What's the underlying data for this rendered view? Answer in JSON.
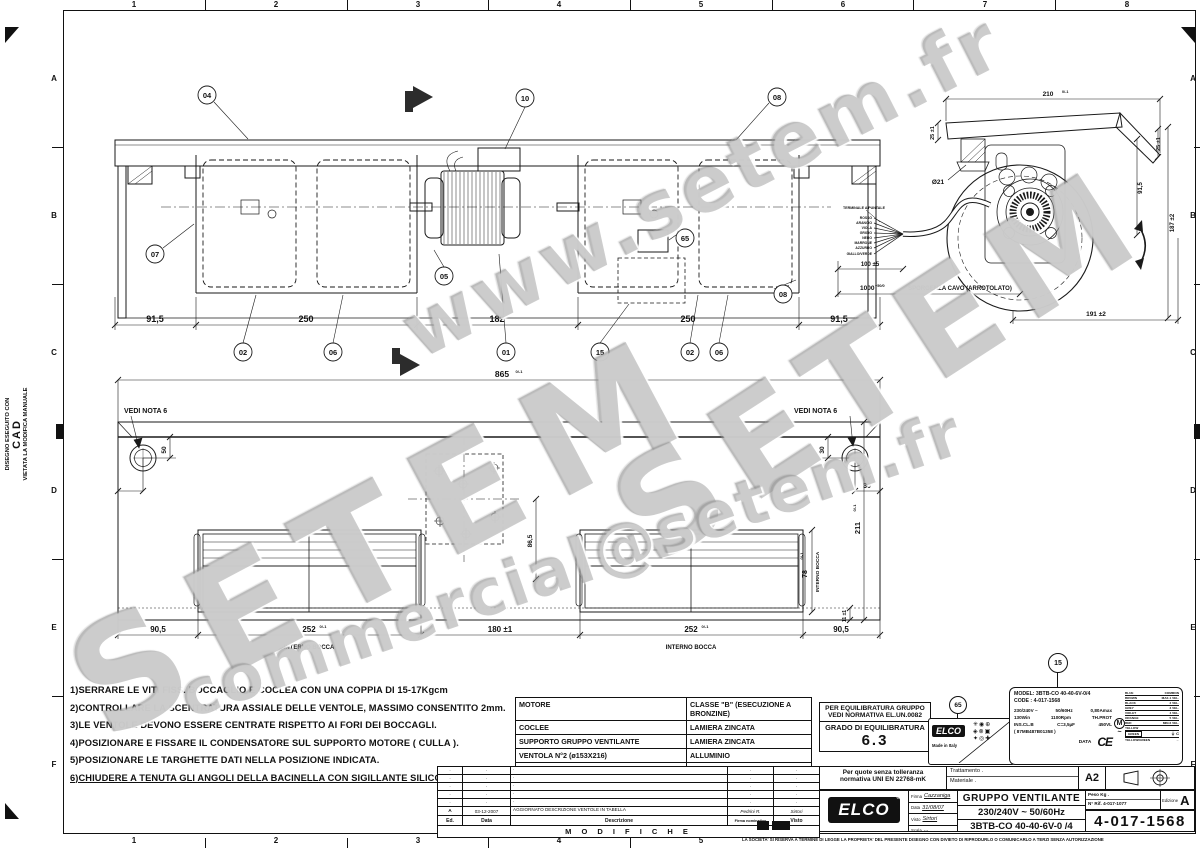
{
  "sheet": {
    "cols": [
      "1",
      "2",
      "3",
      "4",
      "5",
      "6",
      "7",
      "8"
    ],
    "rows": [
      "A",
      "B",
      "C",
      "D",
      "E",
      "F"
    ],
    "cad_note": {
      "l1": "DISEGNO ESEGUITO CON",
      "l2": "CAD",
      "l3": "VIETATA LA MODIFICA MANUALE"
    }
  },
  "watermarks": {
    "url": "www.setem.fr",
    "brand": "SETEM",
    "brand2": "SETEM",
    "email": "commercial@setem.fr"
  },
  "callouts": {
    "n01": "01",
    "n02": "02",
    "n04": "04",
    "n05": "05",
    "n06": "06",
    "n07": "07",
    "n08": "08",
    "n10": "10",
    "n15": "15",
    "n65": "65"
  },
  "top_view": {
    "dims": {
      "d1": "91,5",
      "d2": "250",
      "d3": "182",
      "d4": "250",
      "d5": "91,5"
    }
  },
  "side_view": {
    "dims": {
      "width": "210",
      "width_tol": "0/-1",
      "flange_left": "25 ±1",
      "hole": "Ø21",
      "flange_right": "25 ±1",
      "mid_height": "91,5",
      "total_height": "187 ±2",
      "base": "191 ±2",
      "cable_free": "100 ±5",
      "cable_len": "1000",
      "cable_len_tol": "+50/0"
    },
    "cable_label": "SPORGENZA CAVO (ARROTOLATO)",
    "terminal_label": "TERMINALE A PUNTALE",
    "wires": [
      "ROSSO",
      "ARANCIO",
      "VIOLA",
      "GRIGIO",
      "NERO",
      "MARRONE",
      "AZZURRO",
      "GIALLO/VERDE"
    ]
  },
  "bottom_view": {
    "note": "VEDI NOTA 6",
    "interno_bocca": "INTERNO BOCCA",
    "dims": {
      "total": "865",
      "total_tol": "0/-1",
      "left_v": "50",
      "left_h": "30",
      "right_v": "30",
      "right_h": "30",
      "plate_offset": "86,5",
      "height": "211",
      "height_tol": "0/-1",
      "bocca_h": "78",
      "bocca_h_tol": "0/-1",
      "lip": "11 ±1",
      "b1": "90,5",
      "b2": "252",
      "b2_tol": "0/-1",
      "b3": "180 ±1",
      "b4": "252",
      "b4_tol": "0/-1",
      "b5": "90,5"
    }
  },
  "notes": [
    "1)SERRARE LE VITI FISS. BOCCAGLIO E COCLEA CON UNA COPPIA DI 15-17Kgcm",
    "2)CONTROLLARE LA SCENTRATURA ASSIALE DELLE VENTOLE, MASSIMO CONSENTITO 2mm.",
    "3)LE VENTOLE DEVONO ESSERE CENTRATE RISPETTO AI FORI DEI BOCCAGLI.",
    "4)POSIZIONARE E FISSARE IL CONDENSATORE SUL SUPPORTO MOTORE ( CULLA ).",
    "5)POSIZIONARE LE TARGHETTE DATI NELLA POSIZIONE INDICATA.",
    "6)CHIUDERE A TENUTA GLI ANGOLI DELLA BACINELLA CON SIGILLANTE SILICONICO."
  ],
  "materials": {
    "rows": [
      [
        "MOTORE",
        "CLASSE \"B\" (ESECUZIONE A BRONZINE)"
      ],
      [
        "COCLEE",
        "LAMIERA ZINCATA"
      ],
      [
        "SUPPORTO GRUPPO VENTILANTE",
        "LAMIERA ZINCATA"
      ],
      [
        "VENTOLA N°2 (ø153X216)",
        "ALLUMINIO"
      ],
      [
        "CONTR. ELETTRICO  PRESCRIZIONE",
        "Q.1993/2B"
      ]
    ]
  },
  "balance": {
    "l1": "PER EQUILIBRATURA GRUPPO",
    "l2": "VEDI NORMATIVA EL.UN.0082",
    "label": "GRADO DI EQUILIBRATURA",
    "value": "6.3"
  },
  "sticker": {
    "brand": "ELCO",
    "madein": "Made in Italy"
  },
  "nameplate": {
    "model": "MODEL: 3BTB-CO 40-40-6V-0/4",
    "code": "CODE : 4-017-1568",
    "specs": [
      [
        "230/240V ~",
        "50/60Hz",
        "0,80Amax"
      ],
      [
        "130Win",
        "1100Rpm",
        "TH.PROT"
      ],
      [
        "INS.CL.B",
        "C=3,5µF",
        "450VL"
      ]
    ],
    "serial": "( 87MB487B01358 )",
    "data_label": "DATA",
    "ce": "CE",
    "motor": "M",
    "phase": "~",
    "wires": [
      [
        "BLUE",
        "COMMON"
      ],
      [
        "BROWN",
        "MAX-1 VEL."
      ],
      [
        "BLACK",
        "2 VEL."
      ],
      [
        "GREY",
        "3 VEL."
      ],
      [
        "VIOLET",
        "4 VEL."
      ],
      [
        "ORANGE",
        "5 VEL."
      ],
      [
        "RED",
        "MIN-6 VEL."
      ],
      [
        "YELLOW",
        ""
      ],
      [
        "GREEN",
        "⏚ C"
      ],
      [
        "YELLOW/GREEN",
        "→"
      ]
    ]
  },
  "mods": {
    "title": "M O D I F I C H E",
    "headers": [
      "Ed.",
      "Data",
      "Descrizione",
      "Firma nominativo",
      "Visto"
    ],
    "rows": [
      [
        ".",
        ".",
        ".",
        ".",
        "."
      ],
      [
        ".",
        ".",
        ".",
        ".",
        "."
      ],
      [
        ".",
        ".",
        ".",
        ".",
        "."
      ],
      [
        ".",
        ".",
        ".",
        ".",
        "."
      ],
      [
        ".",
        ".",
        ".",
        ".",
        "."
      ],
      [
        "A",
        "03-12-2007",
        "AGGIORNATO DESCRIZIONE VENTOLE IN TABELLA",
        "Pedrini R.",
        "Sirtori"
      ]
    ]
  },
  "title_block": {
    "tol1": "Per quote senza tolleranza",
    "tol2": "normativa UNI EN 22768-mK",
    "treatment": "Trattamento  .",
    "material": "Materiale    .",
    "format": "A2",
    "brand": "ELCO",
    "reg": "®",
    "firma_label": "Firma",
    "firma": "Cazzaniga",
    "data_label": "Data",
    "data": "31/08/07",
    "visto_label": "Visto",
    "visto": "Sirtori",
    "scala_label": "Scala",
    "scala": "...",
    "title": "GRUPPO VENTILANTE",
    "voltage": "230/240V ~ 50/60Hz",
    "model": "3BTB-CO 40-40-6V-0 /4",
    "peso": "Peso Kg .",
    "rif": "N° Rif. 4-017-1077",
    "edizione_label": "Edizione",
    "edizione": "A",
    "number": "4-017-1568",
    "legal": "LA SOCIETA' SI RISERVA A TERMINE DI LEGGE LA PROPRIETA' DEL PRESENTE DISEGNO CON DIVIETO DI RIPRODURLO O COMUNICARLO A TERZI SENZA AUTORIZZAZIONE"
  }
}
